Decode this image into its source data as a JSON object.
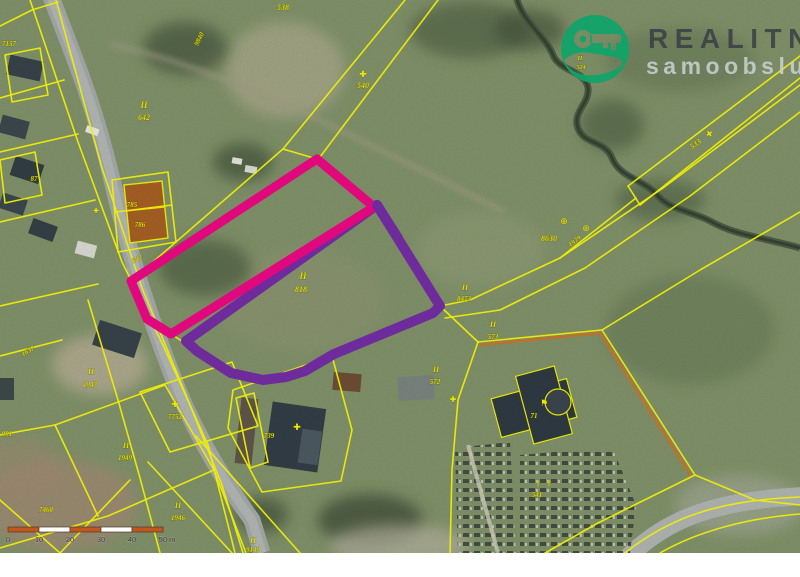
{
  "logo": {
    "line1": "REALITNÍ",
    "line2": "samoobsluha",
    "icon": "hand-holding-key-icon",
    "circle_color": "#12a368"
  },
  "scale_bar": {
    "tick_labels": [
      "0",
      "10",
      "20",
      "30",
      "40",
      "50 m"
    ],
    "segment_count": 5,
    "segment_px": 31,
    "origin_x": 8,
    "bar_y": 527,
    "bar_color": "#c2571e",
    "alt_color": "#ffffff"
  },
  "highlights": {
    "pink": {
      "color": "#e0087c",
      "width": 9,
      "points": "317,159 374,207 171,334 147,319 131,281"
    },
    "purple": {
      "color": "#6e2b9c",
      "width": 10,
      "points": "377,205 440,306 433,313 334,354 305,371 286,377 263,380 231,373 197,351 186,341"
    }
  },
  "parcel_labels": [
    {
      "t": "7157",
      "x": 9,
      "y": 46,
      "r": 0,
      "s": 7
    },
    {
      "t": "538",
      "x": 283,
      "y": 10,
      "r": 0,
      "s": 8
    },
    {
      "t": "9840",
      "x": 201,
      "y": 40,
      "r": -63,
      "s": 7
    },
    {
      "t": "II",
      "x": 144,
      "y": 108,
      "r": 0,
      "s": 9
    },
    {
      "t": "642",
      "x": 144,
      "y": 120,
      "r": 0,
      "s": 8
    },
    {
      "t": "540",
      "x": 363,
      "y": 88,
      "r": 0,
      "s": 8
    },
    {
      "t": "87",
      "x": 34,
      "y": 181,
      "r": 0,
      "s": 7
    },
    {
      "t": "785",
      "x": 132,
      "y": 207,
      "r": 0,
      "s": 7
    },
    {
      "t": "786",
      "x": 140,
      "y": 227,
      "r": 0,
      "s": 7
    },
    {
      "t": "542",
      "x": 138,
      "y": 261,
      "r": -25,
      "s": 7
    },
    {
      "t": "II",
      "x": 580,
      "y": 60,
      "r": 0,
      "s": 6
    },
    {
      "t": "524",
      "x": 581,
      "y": 69,
      "r": 0,
      "s": 6
    },
    {
      "t": "8630",
      "x": 549,
      "y": 241,
      "r": 0,
      "s": 8
    },
    {
      "t": "1979",
      "x": 576,
      "y": 243,
      "r": -38,
      "s": 7
    },
    {
      "t": "533",
      "x": 697,
      "y": 146,
      "r": -37,
      "s": 8
    },
    {
      "t": "II",
      "x": 303,
      "y": 279,
      "r": 0,
      "s": 9
    },
    {
      "t": "818",
      "x": 301,
      "y": 292,
      "r": 0,
      "s": 8
    },
    {
      "t": "II",
      "x": 465,
      "y": 290,
      "r": 0,
      "s": 8
    },
    {
      "t": "8473",
      "x": 464,
      "y": 301,
      "r": 0,
      "s": 7
    },
    {
      "t": "II",
      "x": 493,
      "y": 327,
      "r": 0,
      "s": 8
    },
    {
      "t": "573",
      "x": 493,
      "y": 339,
      "r": 0,
      "s": 7
    },
    {
      "t": "II",
      "x": 436,
      "y": 372,
      "r": 0,
      "s": 8
    },
    {
      "t": "572",
      "x": 435,
      "y": 384,
      "r": 0,
      "s": 7
    },
    {
      "t": "1637",
      "x": 29,
      "y": 353,
      "r": -30,
      "s": 7
    },
    {
      "t": "II",
      "x": 91,
      "y": 374,
      "r": 0,
      "s": 8
    },
    {
      "t": "1947",
      "x": 90,
      "y": 387,
      "r": 0,
      "s": 7
    },
    {
      "t": "991",
      "x": 7,
      "y": 436,
      "r": 0,
      "s": 7
    },
    {
      "t": "7752",
      "x": 175,
      "y": 419,
      "r": 0,
      "s": 7
    },
    {
      "t": "739",
      "x": 269,
      "y": 438,
      "r": 0,
      "s": 7
    },
    {
      "t": "II",
      "x": 126,
      "y": 448,
      "r": 0,
      "s": 8
    },
    {
      "t": "1949",
      "x": 125,
      "y": 460,
      "r": 0,
      "s": 7
    },
    {
      "t": "71",
      "x": 534,
      "y": 418,
      "r": 0,
      "s": 7
    },
    {
      "t": "541",
      "x": 537,
      "y": 497,
      "r": 0,
      "s": 7
    },
    {
      "t": "7468",
      "x": 46,
      "y": 512,
      "r": 0,
      "s": 7
    },
    {
      "t": "II",
      "x": 178,
      "y": 508,
      "r": 0,
      "s": 8
    },
    {
      "t": "1946",
      "x": 178,
      "y": 520,
      "r": 0,
      "s": 7
    },
    {
      "t": "II",
      "x": 253,
      "y": 543,
      "r": 0,
      "s": 8
    },
    {
      "t": "9149",
      "x": 253,
      "y": 552,
      "r": 0,
      "s": 7
    }
  ],
  "map_symbols": [
    {
      "g": "✚",
      "x": 363,
      "y": 77,
      "s": 9,
      "r": 0
    },
    {
      "g": "⊕",
      "x": 564,
      "y": 224,
      "s": 9,
      "r": 0
    },
    {
      "g": "⊕",
      "x": 586,
      "y": 231,
      "s": 9,
      "r": 0
    },
    {
      "g": "✚",
      "x": 711,
      "y": 136,
      "s": 8,
      "r": -37
    },
    {
      "g": "✚",
      "x": 175,
      "y": 407,
      "s": 9,
      "r": 0
    },
    {
      "g": "✚",
      "x": 297,
      "y": 430,
      "s": 9,
      "r": 0
    },
    {
      "g": "⚑",
      "x": 544,
      "y": 406,
      "s": 9,
      "r": 0
    },
    {
      "g": "†",
      "x": 538,
      "y": 486,
      "s": 8,
      "r": 0
    },
    {
      "g": "†",
      "x": 549,
      "y": 486,
      "s": 8,
      "r": 0
    },
    {
      "g": "✚",
      "x": 96,
      "y": 213,
      "s": 7,
      "r": 0
    },
    {
      "g": "✚",
      "x": 453,
      "y": 402,
      "s": 8,
      "r": 0
    }
  ]
}
